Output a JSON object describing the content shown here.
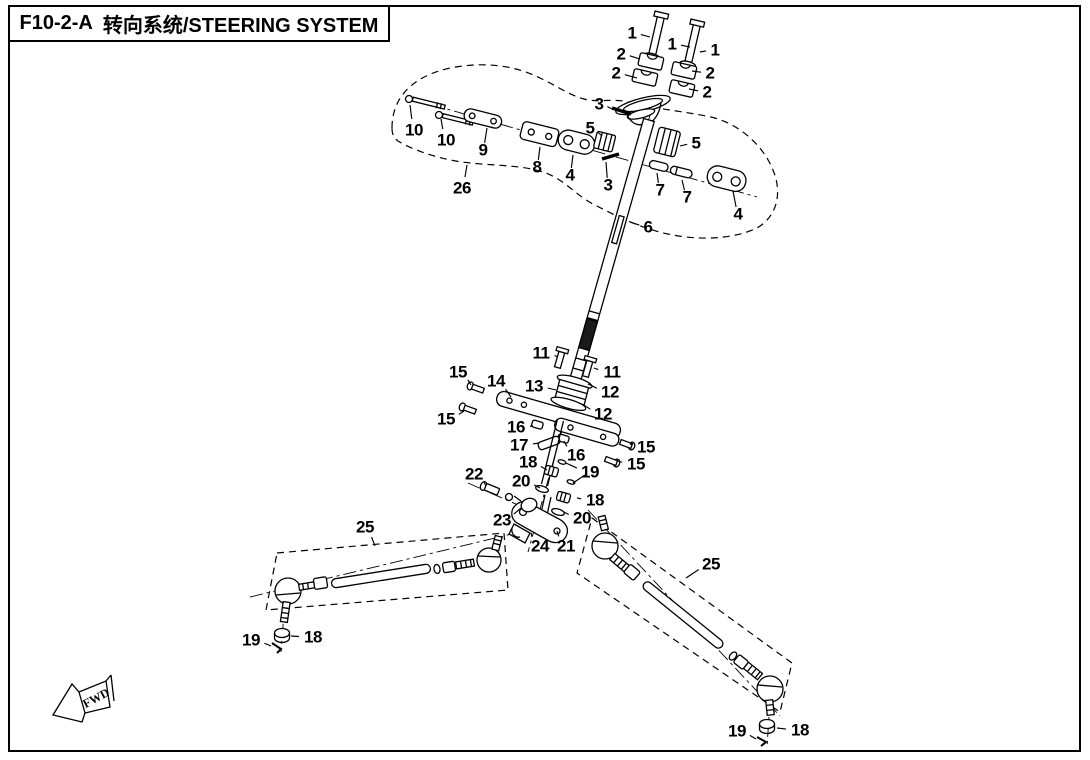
{
  "page": {
    "background": "#ffffff",
    "line_color": "#000000"
  },
  "title_block": {
    "code": "F10-2-A",
    "name": "转向系统/STEERING SYSTEM"
  },
  "fwd_marker": {
    "label": "FWD"
  },
  "callouts": [
    {
      "label": "1",
      "x": 632,
      "y": 33,
      "lx": 650,
      "ly": 37
    },
    {
      "label": "1",
      "x": 672,
      "y": 44,
      "lx": 690,
      "ly": 47
    },
    {
      "label": "1",
      "x": 715,
      "y": 50,
      "lx": 700,
      "ly": 52
    },
    {
      "label": "2",
      "x": 621,
      "y": 54,
      "lx": 640,
      "ly": 59
    },
    {
      "label": "2",
      "x": 616,
      "y": 73,
      "lx": 637,
      "ly": 78
    },
    {
      "label": "2",
      "x": 710,
      "y": 73,
      "lx": 692,
      "ly": 71
    },
    {
      "label": "2",
      "x": 707,
      "y": 92,
      "lx": 689,
      "ly": 89
    },
    {
      "label": "3",
      "x": 599,
      "y": 104,
      "lx": 612,
      "ly": 109
    },
    {
      "label": "3",
      "x": 608,
      "y": 185,
      "lx": 606,
      "ly": 162
    },
    {
      "label": "4",
      "x": 570,
      "y": 175,
      "lx": 573,
      "ly": 155
    },
    {
      "label": "4",
      "x": 738,
      "y": 214,
      "lx": 733,
      "ly": 191
    },
    {
      "label": "5",
      "x": 590,
      "y": 128,
      "lx": 602,
      "ly": 136
    },
    {
      "label": "5",
      "x": 696,
      "y": 143,
      "lx": 680,
      "ly": 146
    },
    {
      "label": "6",
      "x": 648,
      "y": 227,
      "lx": 630,
      "ly": 222
    },
    {
      "label": "7",
      "x": 660,
      "y": 190,
      "lx": 657,
      "ly": 173
    },
    {
      "label": "7",
      "x": 687,
      "y": 197,
      "lx": 682,
      "ly": 180
    },
    {
      "label": "8",
      "x": 537,
      "y": 167,
      "lx": 540,
      "ly": 147
    },
    {
      "label": "9",
      "x": 483,
      "y": 150,
      "lx": 487,
      "ly": 128
    },
    {
      "label": "10",
      "x": 414,
      "y": 130,
      "lx": 410,
      "ly": 105
    },
    {
      "label": "10",
      "x": 446,
      "y": 140,
      "lx": 441,
      "ly": 119
    },
    {
      "label": "11",
      "x": 541,
      "y": 353,
      "lx": 558,
      "ly": 357
    },
    {
      "label": "11",
      "x": 612,
      "y": 372,
      "lx": 594,
      "ly": 368
    },
    {
      "label": "12",
      "x": 610,
      "y": 392,
      "lx": 588,
      "ly": 384
    },
    {
      "label": "12",
      "x": 603,
      "y": 414,
      "lx": 582,
      "ly": 404
    },
    {
      "label": "13",
      "x": 534,
      "y": 386,
      "lx": 556,
      "ly": 390
    },
    {
      "label": "14",
      "x": 496,
      "y": 381,
      "lx": 511,
      "ly": 397
    },
    {
      "label": "15",
      "x": 458,
      "y": 372,
      "lx": 471,
      "ly": 385
    },
    {
      "label": "15",
      "x": 446,
      "y": 419,
      "lx": 464,
      "ly": 411
    },
    {
      "label": "15",
      "x": 646,
      "y": 447,
      "lx": 630,
      "ly": 444
    },
    {
      "label": "15",
      "x": 636,
      "y": 464,
      "lx": 617,
      "ly": 461
    },
    {
      "label": "16",
      "x": 516,
      "y": 427,
      "lx": 533,
      "ly": 426
    },
    {
      "label": "16",
      "x": 576,
      "y": 455,
      "lx": 564,
      "ly": 441
    },
    {
      "label": "17",
      "x": 519,
      "y": 445,
      "lx": 539,
      "ly": 443
    },
    {
      "label": "18",
      "x": 528,
      "y": 462,
      "lx": 547,
      "ly": 470
    },
    {
      "label": "18",
      "x": 595,
      "y": 500,
      "lx": 577,
      "ly": 498
    },
    {
      "label": "18",
      "x": 313,
      "y": 637,
      "lx": 291,
      "ly": 636
    },
    {
      "label": "18",
      "x": 800,
      "y": 730,
      "lx": 777,
      "ly": 728
    },
    {
      "label": "19",
      "x": 590,
      "y": 472,
      "lx": 566,
      "ly": 463
    },
    {
      "label": "19",
      "x": 251,
      "y": 640,
      "lx": 271,
      "ly": 646
    },
    {
      "label": "19",
      "x": 737,
      "y": 731,
      "lx": 756,
      "ly": 739
    },
    {
      "label": "20",
      "x": 521,
      "y": 481,
      "lx": 540,
      "ly": 488
    },
    {
      "label": "20",
      "x": 582,
      "y": 518,
      "lx": 564,
      "ly": 512
    },
    {
      "label": "21",
      "x": 566,
      "y": 546,
      "lx": 557,
      "ly": 531
    },
    {
      "label": "22",
      "x": 474,
      "y": 474,
      "lx": 486,
      "ly": 486
    },
    {
      "label": "23",
      "x": 502,
      "y": 520,
      "lx": 521,
      "ly": 508
    },
    {
      "label": "24",
      "x": 540,
      "y": 546,
      "lx": 531,
      "ly": 533
    },
    {
      "label": "25",
      "x": 365,
      "y": 527,
      "lx": 375,
      "ly": 546
    },
    {
      "label": "25",
      "x": 711,
      "y": 564,
      "lx": 686,
      "ly": 578
    },
    {
      "label": "26",
      "x": 462,
      "y": 188,
      "lx": 467,
      "ly": 165
    }
  ]
}
